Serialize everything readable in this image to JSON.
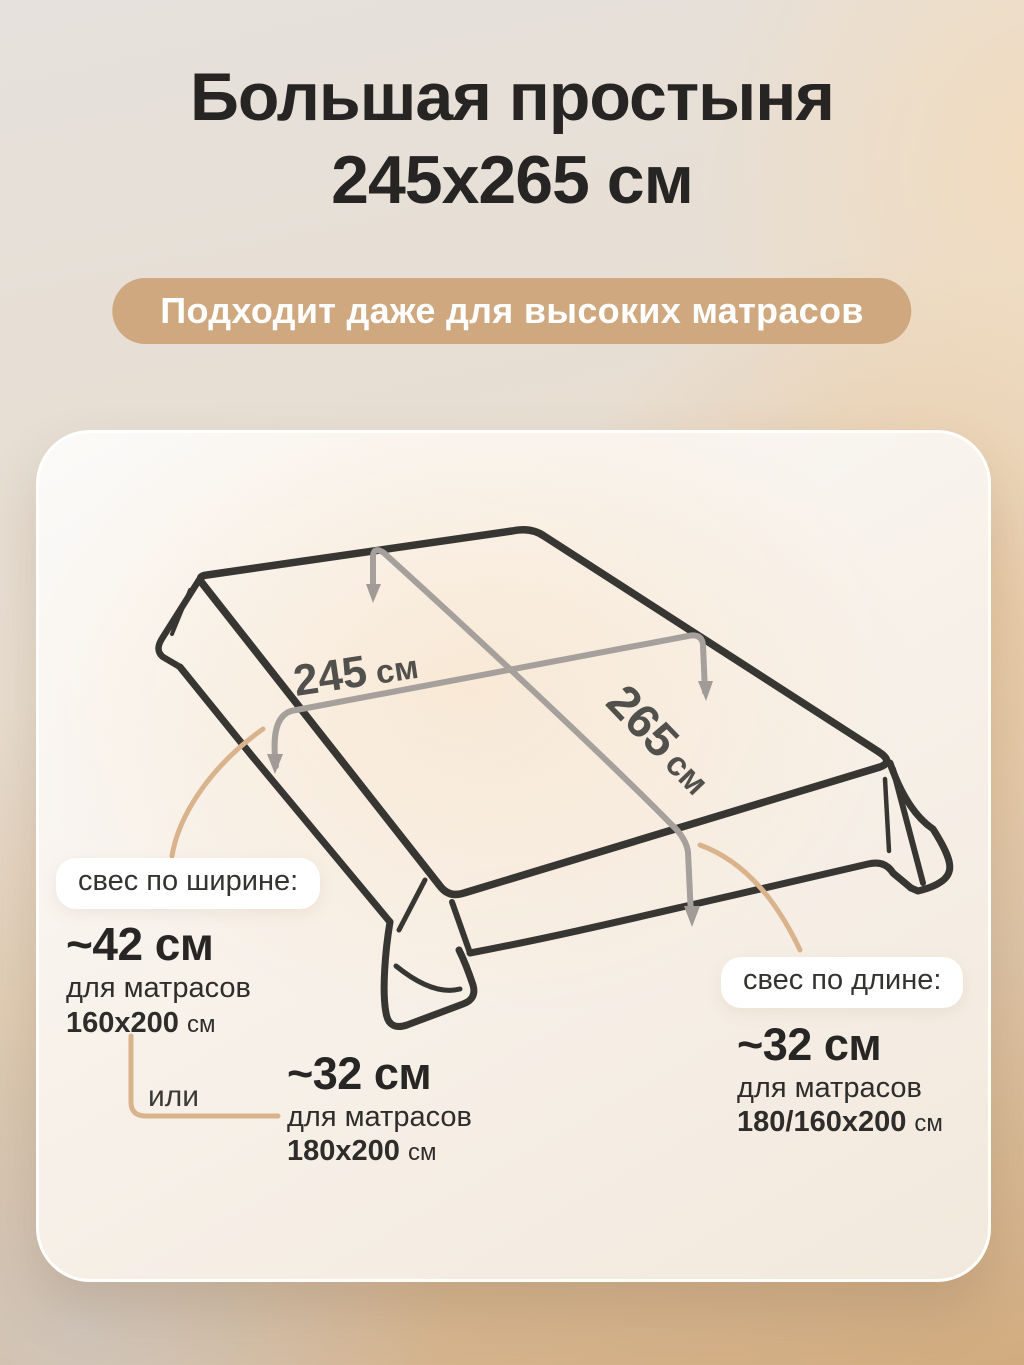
{
  "header": {
    "title_line1": "Большая простыня",
    "title_line2": "245x265 см",
    "badge": "Подходит даже для высоких матрасов"
  },
  "diagram": {
    "width_value": "245",
    "width_unit": "см",
    "length_value": "265",
    "length_unit": "см"
  },
  "annotations": {
    "width_overhang": {
      "pill": "свес по ширине:",
      "value": "~42 см",
      "for_label": "для матрасов",
      "size": "160x200",
      "unit": "см"
    },
    "or_label": "или",
    "width_overhang_alt": {
      "value": "~32 см",
      "for_label": "для матрасов",
      "size": "180x200",
      "unit": "см"
    },
    "length_overhang": {
      "pill": "свес по длине:",
      "value": "~32 см",
      "for_label": "для матрасов",
      "size": "180/160x200",
      "unit": "см"
    }
  },
  "colors": {
    "badge_bg": "#cfa87f",
    "outline_dark": "#383633",
    "measure_gray": "#a5a09b",
    "connector_tan": "#d9b38c",
    "title_text": "#262524"
  }
}
